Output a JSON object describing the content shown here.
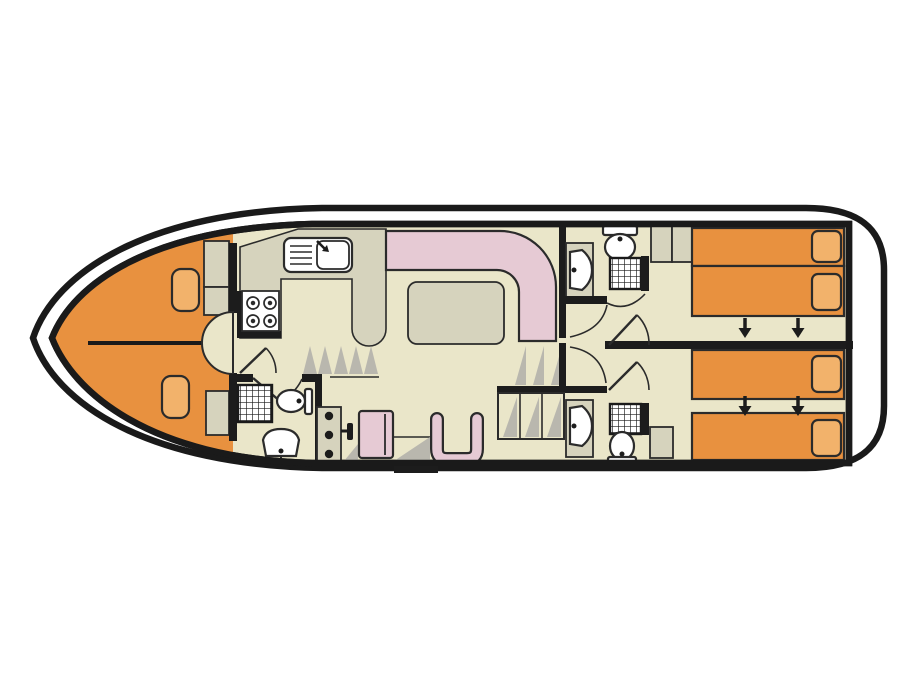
{
  "meta": {
    "kind": "houseboat-deck-plan",
    "description-name": "boat-floor-plan"
  },
  "colors": {
    "page-bg": "#ffffff",
    "hull-line": "#1a1a1a",
    "wall": "#1c1c1c",
    "outline": "#2b2b2b",
    "floor": "#eae6c9",
    "counter": "#d6d3bd",
    "bed-orange": "#e8913f",
    "pillow-orange": "#f2b26b",
    "sofa-pink": "#e6cad4",
    "shadow": "#b9b7ae",
    "white": "#ffffff"
  },
  "inventory": {
    "bow-cabin": [
      "v-berth-double",
      "pillow",
      "pillow",
      "wardrobe",
      "wardrobe",
      "entry-recess"
    ],
    "galley": [
      "sink-with-drainer",
      "faucet",
      "stove-4-burner",
      "counter-peninsula"
    ],
    "saloon": [
      "l-shaped-sofa",
      "dining-table",
      "entry-steps"
    ],
    "helm": [
      "instrument-console",
      "throttle-lever",
      "bench-seat",
      "helm-chair",
      "side-door"
    ],
    "front-bathroom": [
      "shower",
      "toilet",
      "washbasin"
    ],
    "mid-bathroom-top": [
      "washbasin",
      "toilet",
      "shower"
    ],
    "mid-bathroom-bottom": [
      "washbasin",
      "toilet",
      "shower",
      "cabinet"
    ],
    "aft-cabin-top": [
      "single-bed",
      "single-bed",
      "pillow",
      "pillow",
      "wardrobe",
      "wardrobe"
    ],
    "aft-cabin-bottom": [
      "single-bed",
      "single-bed",
      "pillow",
      "pillow",
      "cabinet"
    ],
    "stairs": [
      "companionway-steps"
    ]
  },
  "bed_slide_arrows": [
    {
      "x": 745,
      "y": 318
    },
    {
      "x": 798,
      "y": 318
    },
    {
      "x": 745,
      "y": 396
    },
    {
      "x": 798,
      "y": 396
    }
  ],
  "arrow_style": {
    "shaft": 10,
    "head_len": 10,
    "head_w": 13
  }
}
